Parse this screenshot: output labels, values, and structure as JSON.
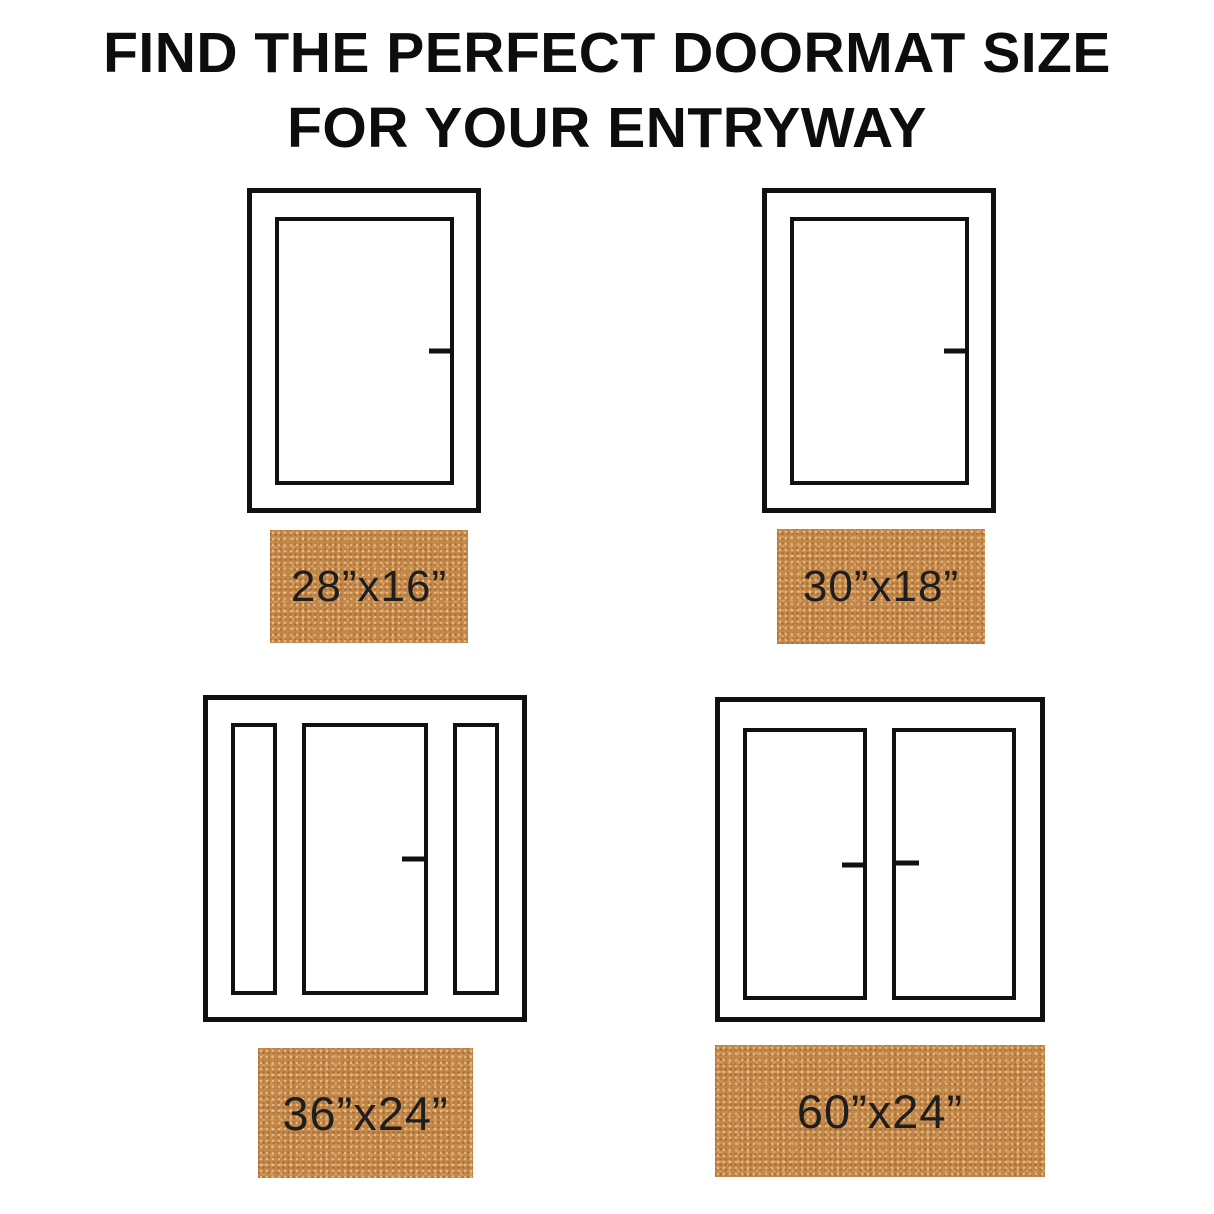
{
  "title": {
    "line1": "FIND THE PERFECT DOORMAT SIZE",
    "line2": "FOR YOUR ENTRYWAY"
  },
  "colors": {
    "background": "#ffffff",
    "line_art": "#111111",
    "doormat": "#c4874a",
    "doormat_text": "#1e1e1e",
    "title_text": "#0d0d0d"
  },
  "entries": [
    {
      "door_type": "single-door",
      "mat_label": "28”x16”"
    },
    {
      "door_type": "single-door",
      "mat_label": "30”x18”"
    },
    {
      "door_type": "door-with-sidelights",
      "mat_label": "36”x24”"
    },
    {
      "door_type": "double-door",
      "mat_label": "60”x24”"
    }
  ]
}
